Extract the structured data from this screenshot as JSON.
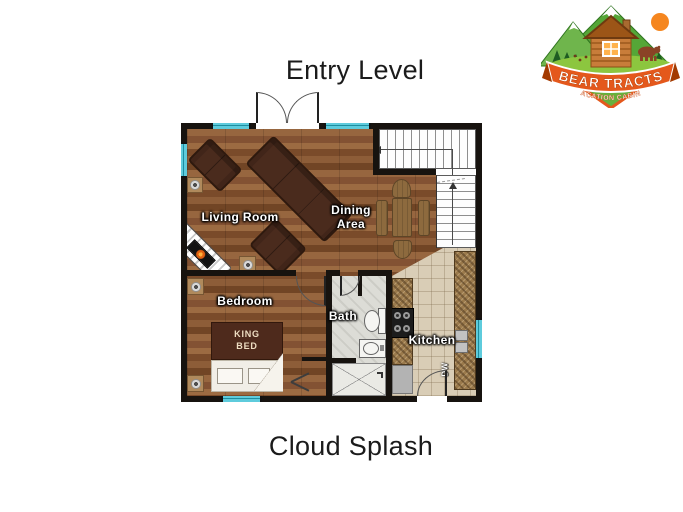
{
  "header": {
    "plan_title": "Entry Level"
  },
  "footer": {
    "cabin_name": "Cloud Splash"
  },
  "logo": {
    "brand_line1": "BEAR TRACTS",
    "brand_line2": "VACATION CABINS"
  },
  "floorplan": {
    "rooms": {
      "living_room": {
        "label": "Living Room"
      },
      "dining_area": {
        "label": "Dining Area"
      },
      "bedroom": {
        "label": "Bedroom"
      },
      "bath": {
        "label": "Bath"
      },
      "kitchen": {
        "label": "Kitchen"
      }
    },
    "furniture": {
      "king_bed": {
        "label": "KING BED"
      },
      "dishwasher": {
        "label": "DW"
      }
    },
    "colors": {
      "wall": "#17130f",
      "window_glass": "#5ecbdc",
      "wood_floor": "#8a5a36",
      "kitchen_tile": "#d9cdb6",
      "bath_floor": "#dcdcd6",
      "granite_counter": "#9b7a4c",
      "upholstery": "#4a2b1d",
      "bed": "#4e2a1c",
      "label_text": "#ffffff",
      "logo_banner": "#e4581c",
      "logo_green": "#55a637",
      "logo_sun": "#f5861f"
    }
  }
}
